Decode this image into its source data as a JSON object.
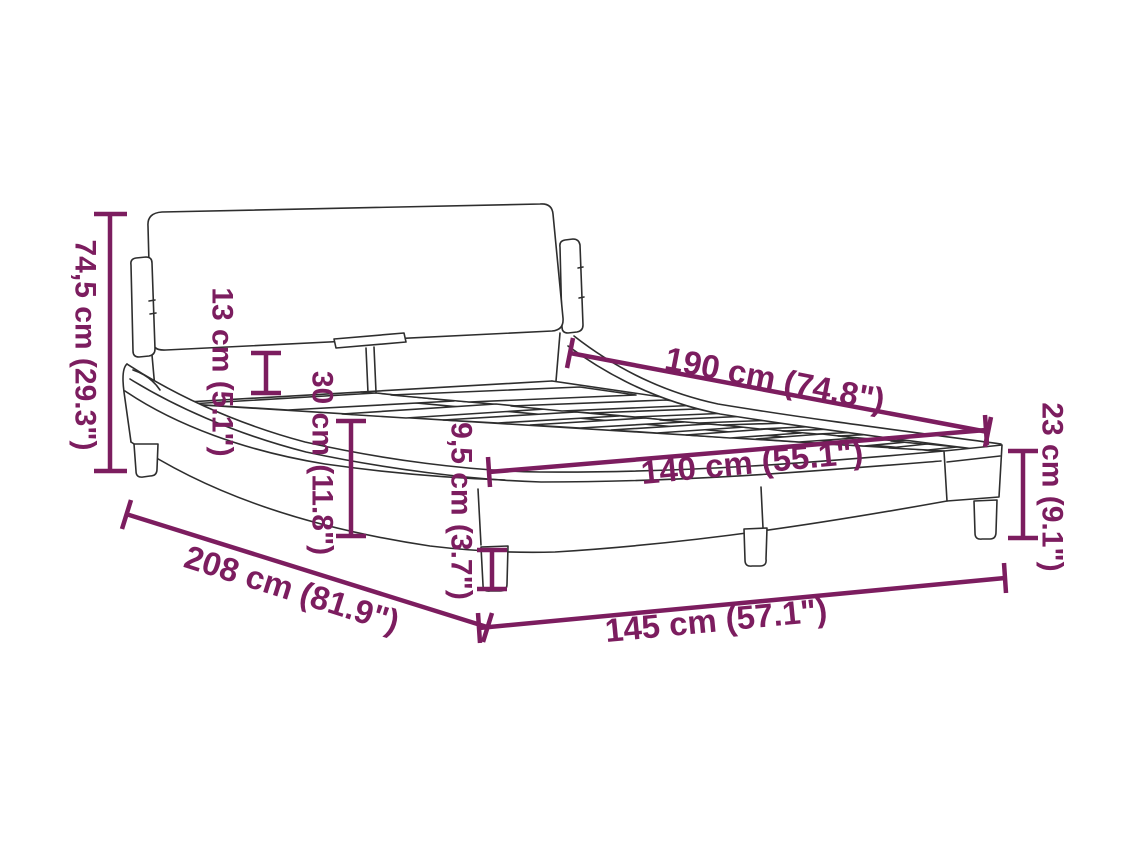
{
  "figure": {
    "title": "Bed frame dimension diagram",
    "background_color": "#ffffff",
    "line_color": "#2e2e2e",
    "dimension_color": "#7c1d5f",
    "dimensions": {
      "headboard_height": "74,5 cm (29.3\")",
      "headboard_cushion_depth": "13 cm (5.1\")",
      "side_rail_height": "30 cm (11.8\")",
      "leg_height": "9,5 cm (3.7\")",
      "frame_end_height": "23 cm (9.1\")",
      "inner_length": "190 cm (74.8\")",
      "inner_width": "140 cm (55.1\")",
      "total_length": "208 cm (81.9\")",
      "total_width": "145 cm (57.1\")"
    }
  }
}
